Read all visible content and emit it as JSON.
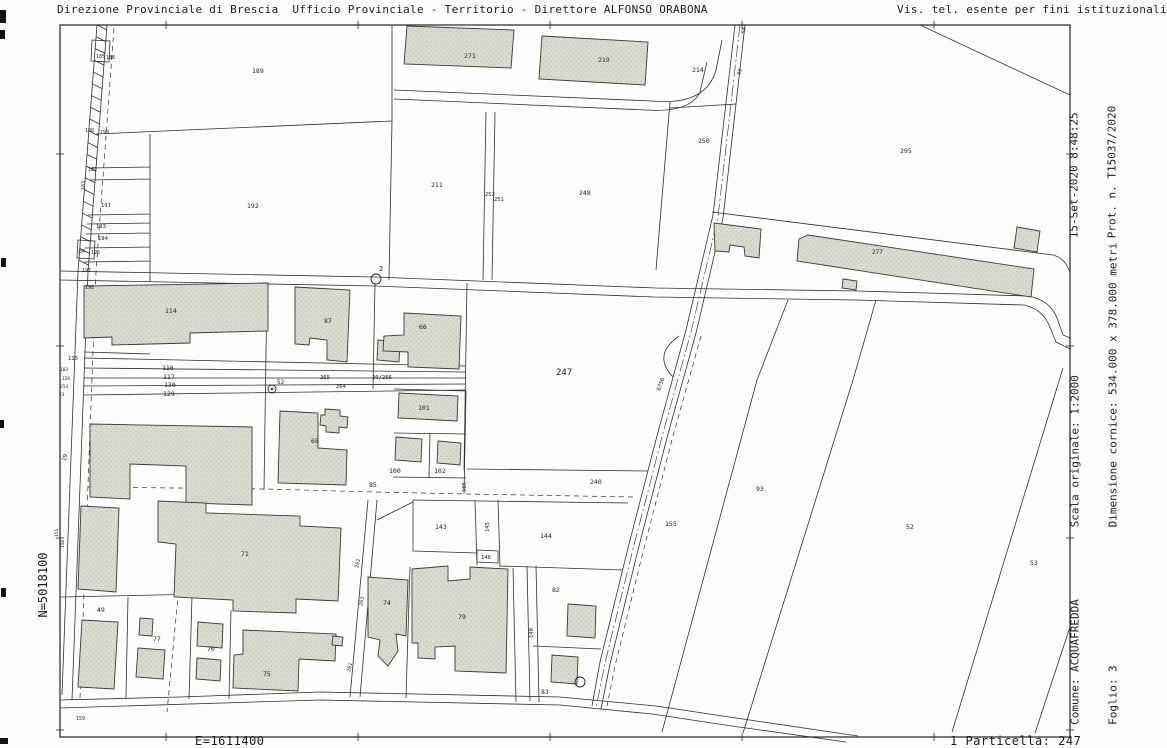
{
  "header": {
    "left": "Direzione Provinciale di Brescia  Ufficio Provinciale - Territorio - Direttore ALFONSO ORABONA",
    "right": "Vis. tel. esente per fini istituzionali"
  },
  "margin_right": {
    "datetime_line1": "15-Set-2020 8:48:25",
    "datetime_line2": "Prot. n. T15037/2020",
    "scale_line1": "Scala originale: 1:2000",
    "scale_line2": "Dimensione cornice: 534.000 x 378.000 metri",
    "comune_line1": "Comune: ACQUAFREDDA",
    "comune_line2": "Foglio: 3"
  },
  "margin_left": {
    "northing": "N=5018100"
  },
  "footer": {
    "easting": "E=1611400",
    "particella": "1 Particella: 247"
  },
  "colors": {
    "paper": "#fdfdfb",
    "line": "#2e2e2e",
    "building_fill": "#d8dccf",
    "building_dot": "#aeb6a2"
  },
  "map": {
    "frame_ticks": {
      "x": [
        166,
        358,
        550,
        742,
        934
      ],
      "y": [
        154,
        346,
        538,
        730
      ]
    },
    "markers": [
      {
        "x": 376,
        "y": 279,
        "r": 5
      },
      {
        "x": 272,
        "y": 389,
        "r": 4,
        "dot": true
      },
      {
        "x": 580,
        "y": 682,
        "r": 5
      }
    ],
    "labels": [
      {
        "t": "189",
        "x": 252,
        "y": 73
      },
      {
        "t": "271",
        "x": 464,
        "y": 58
      },
      {
        "t": "219",
        "x": 598,
        "y": 62
      },
      {
        "t": "214",
        "x": 692,
        "y": 72
      },
      {
        "t": "250",
        "x": 698,
        "y": 143
      },
      {
        "t": "295",
        "x": 900,
        "y": 153
      },
      {
        "t": "211",
        "x": 431,
        "y": 187
      },
      {
        "t": "248",
        "x": 579,
        "y": 195
      },
      {
        "t": "252",
        "x": 485,
        "y": 196,
        "s": 5.5
      },
      {
        "t": "251",
        "x": 494,
        "y": 201,
        "s": 5.5
      },
      {
        "t": "192",
        "x": 247,
        "y": 208
      },
      {
        "t": "2",
        "x": 379,
        "y": 271,
        "s": 7
      },
      {
        "t": "114",
        "x": 165,
        "y": 313
      },
      {
        "t": "87",
        "x": 324,
        "y": 323
      },
      {
        "t": "66",
        "x": 419,
        "y": 329
      },
      {
        "t": "115",
        "x": 68,
        "y": 360,
        "s": 5.5
      },
      {
        "t": "116",
        "x": 162,
        "y": 370
      },
      {
        "t": "117",
        "x": 163,
        "y": 379
      },
      {
        "t": "130",
        "x": 164,
        "y": 387
      },
      {
        "t": "129",
        "x": 163,
        "y": 396
      },
      {
        "t": "265",
        "x": 320,
        "y": 379,
        "s": 5.5
      },
      {
        "t": "264",
        "x": 336,
        "y": 388,
        "s": 5.5
      },
      {
        "t": "20/266",
        "x": 372,
        "y": 379,
        "s": 5.5
      },
      {
        "t": "52",
        "x": 277,
        "y": 384,
        "s": 6
      },
      {
        "t": "247",
        "x": 556,
        "y": 375,
        "s": 9
      },
      {
        "t": "6756",
        "x": 660,
        "y": 391,
        "s": 5.5,
        "r": -70
      },
      {
        "t": "101",
        "x": 418,
        "y": 410
      },
      {
        "t": "68",
        "x": 311,
        "y": 443
      },
      {
        "t": "100",
        "x": 389,
        "y": 473
      },
      {
        "t": "102",
        "x": 434,
        "y": 473
      },
      {
        "t": "85",
        "x": 369,
        "y": 487
      },
      {
        "t": "105",
        "x": 466,
        "y": 492,
        "r": -90,
        "s": 5.5
      },
      {
        "t": "240",
        "x": 590,
        "y": 484
      },
      {
        "t": "93",
        "x": 756,
        "y": 491
      },
      {
        "t": "155",
        "x": 665,
        "y": 526
      },
      {
        "t": "52",
        "x": 906,
        "y": 529
      },
      {
        "t": "53",
        "x": 1030,
        "y": 565
      },
      {
        "t": "143",
        "x": 435,
        "y": 529
      },
      {
        "t": "145",
        "x": 489,
        "y": 532,
        "r": -90,
        "s": 5.5
      },
      {
        "t": "146",
        "x": 481,
        "y": 559,
        "s": 5.5
      },
      {
        "t": "144",
        "x": 540,
        "y": 538
      },
      {
        "t": "71",
        "x": 241,
        "y": 556
      },
      {
        "t": "49",
        "x": 97,
        "y": 612
      },
      {
        "t": "77",
        "x": 153,
        "y": 641
      },
      {
        "t": "70",
        "x": 207,
        "y": 651
      },
      {
        "t": "75",
        "x": 263,
        "y": 676
      },
      {
        "t": "74",
        "x": 383,
        "y": 605
      },
      {
        "t": "79",
        "x": 458,
        "y": 619
      },
      {
        "t": "82",
        "x": 552,
        "y": 592
      },
      {
        "t": "140",
        "x": 533,
        "y": 638,
        "r": -90,
        "s": 5.5
      },
      {
        "t": "83",
        "x": 541,
        "y": 694
      },
      {
        "t": "262",
        "x": 358,
        "y": 568,
        "r": -75,
        "s": 5
      },
      {
        "t": "263",
        "x": 362,
        "y": 606,
        "r": -75,
        "s": 5
      },
      {
        "t": "261",
        "x": 350,
        "y": 672,
        "r": -75,
        "s": 5
      },
      {
        "t": "277",
        "x": 872,
        "y": 254,
        "s": 6,
        "c": "#858a80"
      },
      {
        "t": "100",
        "x": 85,
        "y": 132,
        "s": 5
      },
      {
        "t": "190",
        "x": 100,
        "y": 134,
        "s": 5
      },
      {
        "t": "185",
        "x": 96,
        "y": 58,
        "s": 5
      },
      {
        "t": "188",
        "x": 106,
        "y": 59,
        "s": 5
      },
      {
        "t": "182",
        "x": 88,
        "y": 171,
        "s": 5
      },
      {
        "t": "183",
        "x": 85,
        "y": 190,
        "r": -90,
        "s": 5
      },
      {
        "t": "191",
        "x": 101,
        "y": 207,
        "s": 5.5
      },
      {
        "t": "193",
        "x": 96,
        "y": 228,
        "s": 5.5
      },
      {
        "t": "194",
        "x": 98,
        "y": 240,
        "s": 5.5
      },
      {
        "t": "84",
        "x": 79,
        "y": 253,
        "s": 5
      },
      {
        "t": "195",
        "x": 91,
        "y": 254,
        "s": 5
      },
      {
        "t": "197",
        "x": 82,
        "y": 272,
        "s": 5
      },
      {
        "t": "198",
        "x": 85,
        "y": 289,
        "s": 5
      },
      {
        "t": "29",
        "x": 66,
        "y": 461,
        "r": -80,
        "s": 5.5
      },
      {
        "t": "151",
        "x": 58,
        "y": 537,
        "r": -90,
        "s": 4.5
      },
      {
        "t": "150",
        "x": 64,
        "y": 548,
        "r": -90,
        "s": 4.5
      },
      {
        "t": "159",
        "x": 76,
        "y": 720,
        "s": 5
      },
      {
        "t": "60",
        "x": 744,
        "y": 34,
        "r": -70,
        "s": 5
      },
      {
        "t": "60",
        "x": 740,
        "y": 75,
        "r": -70,
        "s": 5
      },
      {
        "t": "103",
        "x": 60,
        "y": 371,
        "s": 4.5
      },
      {
        "t": "126",
        "x": 62,
        "y": 380,
        "s": 4.5
      },
      {
        "t": "254",
        "x": 60,
        "y": 388,
        "s": 4.5
      },
      {
        "t": "23",
        "x": 59,
        "y": 396,
        "s": 4.5
      }
    ]
  }
}
